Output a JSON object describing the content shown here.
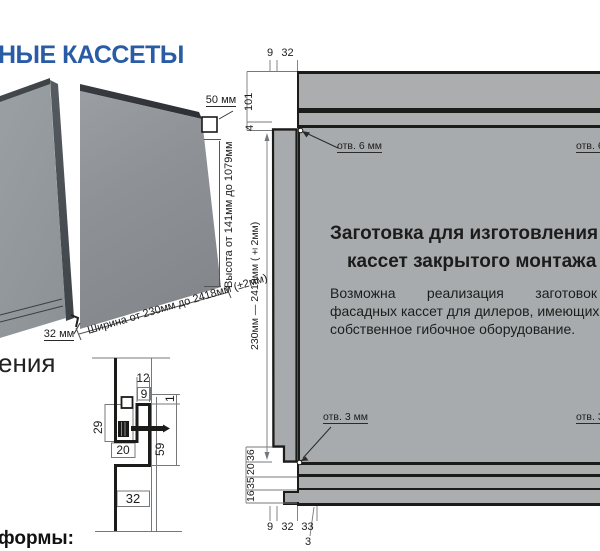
{
  "page": {
    "title": "НЫЕ КАССЕТЫ",
    "left_caption": "ения",
    "bottom_caption": "формы:"
  },
  "colors": {
    "accent_blue": "#2a5ca6",
    "panel_gray": "#a8abad",
    "line_dark": "#1b1b19"
  },
  "iso": {
    "dim_depth": "50 мм",
    "dim_seam": "32 мм",
    "width_range": "Ширина от 230мм до 2418мм (±2мм)",
    "height_range": "Высота от 141мм до 1079мм"
  },
  "section": {
    "dims": {
      "top_width": "12",
      "lip": "9",
      "gap": "1",
      "flange": "29",
      "offset": "20",
      "drop": "59",
      "bottom": "32"
    }
  },
  "blank": {
    "heading_line1": "Заготовка для изготовления",
    "heading_line2": "кассет закрытого монтажа",
    "body_line1": "Возможна реализация заготовок",
    "body_line2": "фасадных кассет для дилеров, имеющих",
    "body_line3": "собственное гибочное оборудование.",
    "hole_top_left": "отв. 6 мм",
    "hole_top_right": "отв. 6 мм",
    "hole_bottom_left": "отв. 3 мм",
    "hole_bottom_right": "отв. 3 мм",
    "dims_top": [
      "9",
      "32"
    ],
    "dims_left_top": [
      "101",
      "4"
    ],
    "height_range": "230мм — 2418мм (±2мм)",
    "dims_bottom_left": [
      "36",
      "20",
      "35",
      "16"
    ],
    "dims_bottom": [
      "9",
      "32",
      "33"
    ],
    "dim_tab": "3"
  }
}
